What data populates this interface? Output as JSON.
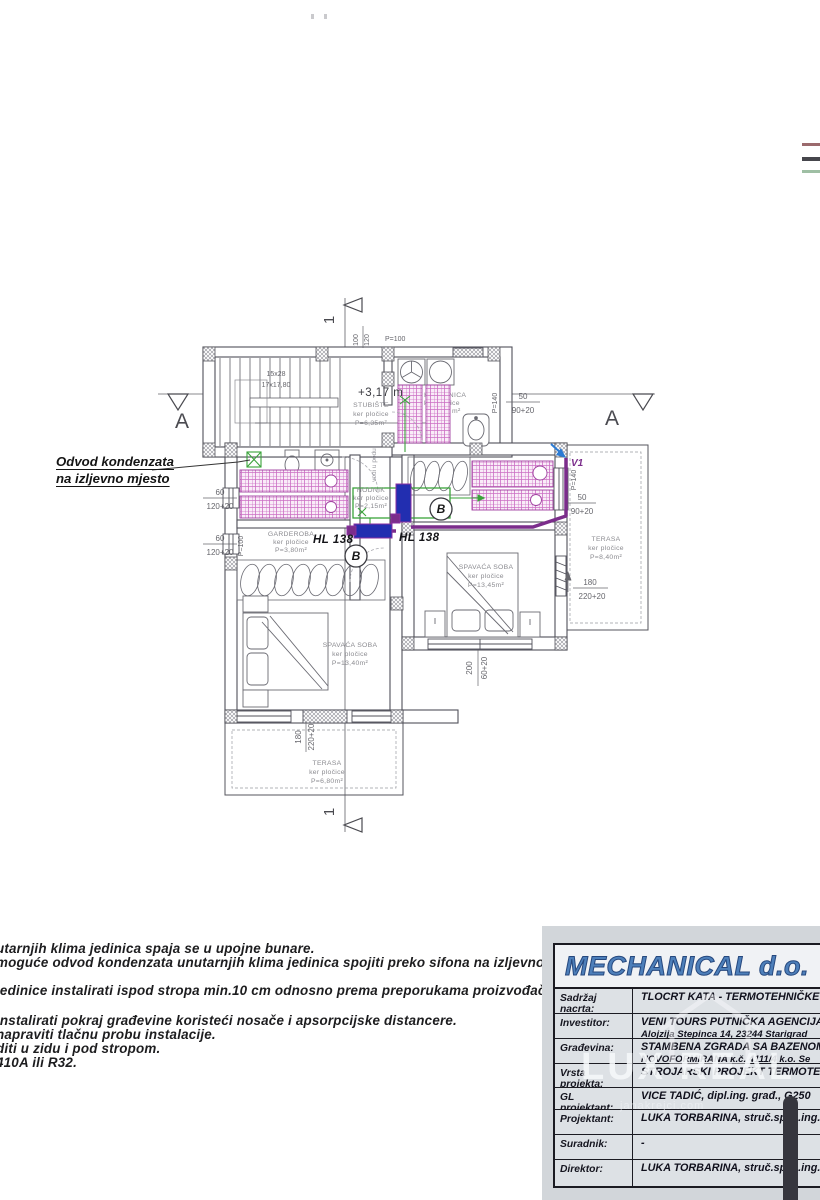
{
  "plan": {
    "section": {
      "a": "A",
      "one": "1"
    },
    "level": "+3,17 m",
    "stairs": {
      "l1": "15x28",
      "l2": "17x17,80"
    },
    "note_floor": "vodi u podu",
    "drain": "HL 138",
    "valve": "V1",
    "bsym": "B",
    "rooms": {
      "stubiste": {
        "n": "STUBIŠTE",
        "s": "ker pločice",
        "a": "P=6,35m²"
      },
      "kupaonica": {
        "n": "KUPAONICA",
        "s": "ker pločice",
        "a": "m²"
      },
      "hodnik": {
        "n": "HODNIK",
        "s": "ker pločice",
        "a": "P=2,15m²"
      },
      "garderoba": {
        "n": "GARDEROBA",
        "s": "ker pločice",
        "a": "P=3,80m²"
      },
      "spavaca_d": {
        "n": "SPAVAĆA SOBA",
        "s": "ker pločice",
        "a": "P=13,45m²"
      },
      "spavaca_l": {
        "n": "SPAVAĆA SOBA",
        "s": "ker pločice",
        "a": "P=13,40m²"
      },
      "terasa_d": {
        "n": "TERASA",
        "s": "ker pločice",
        "a": "P=8,40m²"
      },
      "terasa_b": {
        "n": "TERASA",
        "s": "ker pločice",
        "a": "P=6,80m²"
      }
    },
    "dims": {
      "top_a": "100",
      "top_b": "120",
      "top_c": "P=100",
      "p140": "P=140",
      "p100v": "P=100",
      "win_s": {
        "a": "50",
        "b": "90+20"
      },
      "win_l": {
        "a": "60",
        "b": "120+20"
      },
      "ter": {
        "a": "180",
        "b": "220+20"
      },
      "bed": {
        "a": "200",
        "b": "60+20"
      }
    },
    "colors": {
      "pipe_purple": "#7b2d8b",
      "unit_blue": "#222eb0",
      "condensate_green": "#3aa33a",
      "hatch_magenta": "#cc6fc4",
      "arrow_blue": "#2b7bd4"
    }
  },
  "annotation": {
    "l1": "Odvod kondenzata",
    "l2": "na izljevno mjesto"
  },
  "notes": {
    "lines": [
      "utarnjih klima jedinica spaja se u upojne bunare.",
      "moguće odvod kondenzata unutarnjih klima jedinica spojiti preko sifona na izljevno mjesto ili na",
      "jedinice instalirati ispod stropa min.10 cm odnosno prema preporukama proizvođača ukoliko je",
      "instalirati pokraj građevine koristeći nosače i apsorpcijske distancere.",
      "napraviti tlačnu probu instalacije.",
      "diti u zidu i pod stropom.",
      "410A ili R32."
    ]
  },
  "legend": {
    "colors": [
      "#9b6a6d",
      "#46464c",
      "#9fbfa4"
    ]
  },
  "titleblock": {
    "company": "MECHANICAL d.o.",
    "rows": [
      {
        "label": "Sadržaj nacrta:",
        "value": "TLOCRT KATA  - TERMOTEHNIČKE"
      },
      {
        "label": "Investitor:",
        "value": "VENI TOURS PUTNIČKA AGENCIJA",
        "value2": "Alojzija Stepinca 14, 23244 Starigrad"
      },
      {
        "label": "Građevina:",
        "value": "STAMBENA ZGRADA SA BAZENOM, k.",
        "value2": "NOVOFORMIRANA  k.č. 4111/4 k.o. Se"
      },
      {
        "label": "Vrsta projekta:",
        "value": "STROJARSKI PROJEKT TERMOTEH"
      },
      {
        "label": "GL projektant:",
        "value": "VICE TADIĆ, dipl.ing. građ., G250"
      },
      {
        "label": "Projektant:",
        "value": "LUKA TORBARINA, struč.spec.ing.r"
      },
      {
        "label": "Suradnik:",
        "value": "-"
      },
      {
        "label": "Direktor:",
        "value": "LUKA TORBARINA, struč.spec.ing.r"
      }
    ],
    "watermark": "LUX REAL",
    "watermark_sub": "janakrejci.com"
  }
}
